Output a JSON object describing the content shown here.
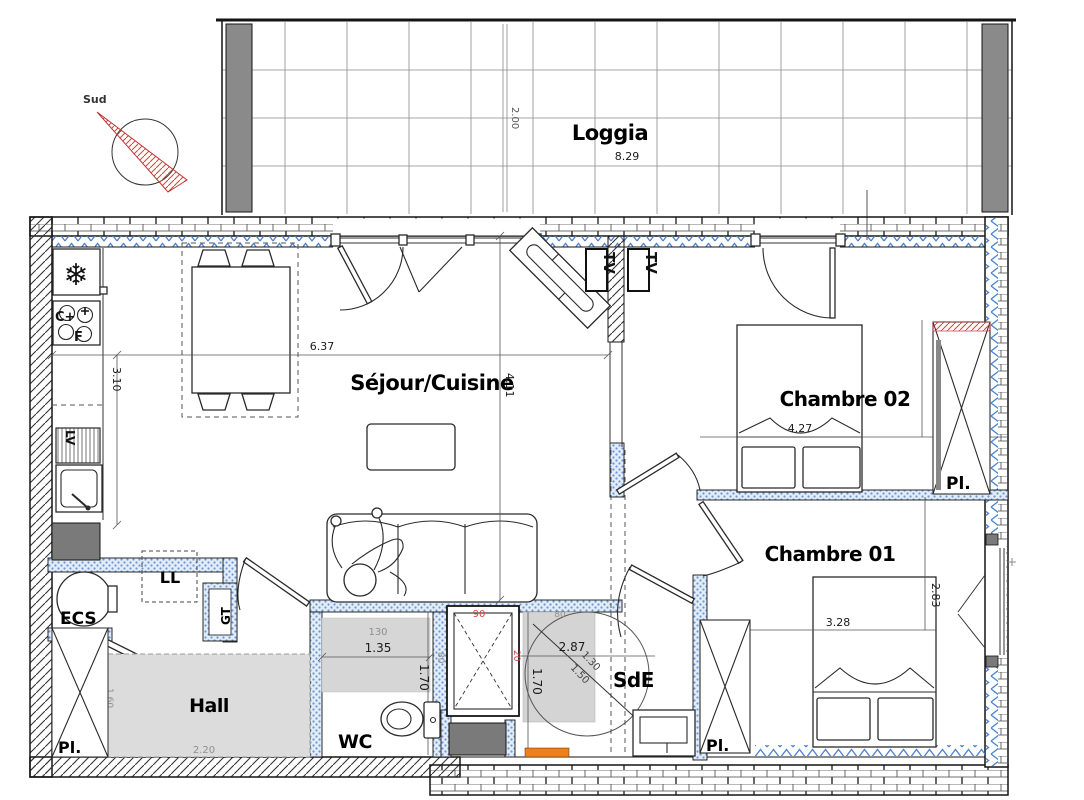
{
  "compass": {
    "label": "Sud"
  },
  "loggia": {
    "label": "Loggia",
    "dim_width": "8.29",
    "dim_depth": "2.00"
  },
  "living": {
    "label": "Séjour/Cuisine",
    "dim_width": "6.37",
    "dim_height": "4.11",
    "dim_kitchen_depth": "3.10",
    "tv_label_1": "TV",
    "tv_label_2": "TV"
  },
  "kitchen": {
    "fridge_icon": "❄",
    "stove_label_1": "C+",
    "stove_label_2": "F",
    "dishwasher_label": "LV"
  },
  "bedroom2": {
    "label": "Chambre 02",
    "dim_width": "4.27",
    "dim_height": "2.84",
    "closet_label": "Pl."
  },
  "bedroom1": {
    "label": "Chambre 01",
    "dim_width": "3.28",
    "dim_height": "2.83",
    "closet_label": "Pl."
  },
  "bathroom": {
    "label": "SdE",
    "dim_width": "2.87",
    "dim_height": "1.70",
    "dim_diag_a": "1.30",
    "dim_diag_b": "1.50",
    "dim_top": "80",
    "dim_left_red": "20",
    "shower_dim_red": "90"
  },
  "wc": {
    "label": "WC",
    "dim_width": "1.35",
    "dim_width_gray": "130",
    "dim_height": "1.70",
    "dim_side_gray": "80"
  },
  "hall": {
    "label": "Hall",
    "dim_width_gray": "2.20",
    "dim_door_gray": "1.60",
    "closet_label": "Pl."
  },
  "utility": {
    "water_heater_label": "ECS",
    "washing_machine_label": "LL",
    "duct_label": "GT"
  },
  "colors": {
    "insulation_blue": "#4d84cf",
    "accent_red": "#d84040",
    "accent_orange": "#ef7f1a",
    "fill_gray": "#d6d6d6",
    "dark_gray": "#7a7a7a"
  }
}
